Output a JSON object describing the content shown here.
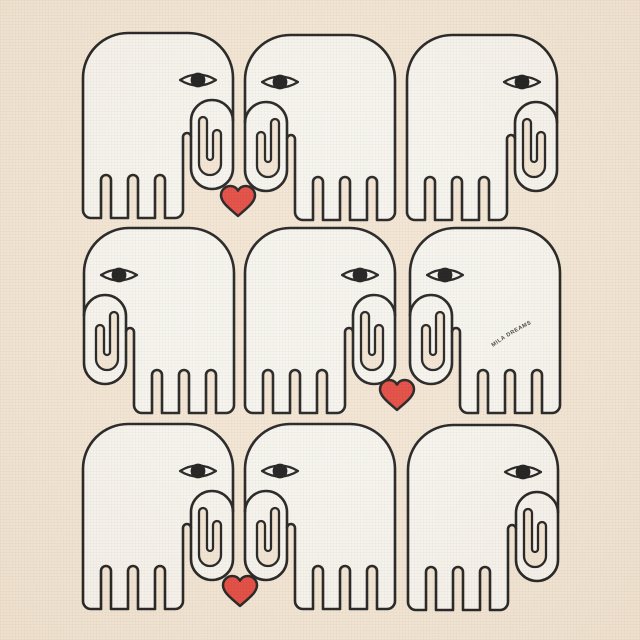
{
  "artwork": {
    "description": "Seamless-style pattern of nine outlined elephants with curled trunks facing each other, with red hearts between kissing trunk pairs, printed on cream fabric.",
    "grid": "3x3"
  },
  "brand": {
    "text": "MILA DREAMS"
  },
  "colors": {
    "background": "#f2e5d3",
    "elephant": "#f6f4ee",
    "outline": "#1c1c1c",
    "heart": "#e2463c",
    "pupil": "#171717",
    "brand_text": "#3c3c3c"
  },
  "figures": {
    "elephant_size": {
      "width": 150,
      "height": 185
    },
    "elephants": [
      {
        "id": "row1-left",
        "x": 83,
        "y": 33,
        "facing": "right"
      },
      {
        "id": "row1-mid",
        "x": 245,
        "y": 35,
        "facing": "left"
      },
      {
        "id": "row1-right",
        "x": 407,
        "y": 35,
        "facing": "right"
      },
      {
        "id": "row2-left",
        "x": 84,
        "y": 228,
        "facing": "left"
      },
      {
        "id": "row2-mid",
        "x": 245,
        "y": 228,
        "facing": "right"
      },
      {
        "id": "row2-right",
        "x": 410,
        "y": 228,
        "facing": "left"
      },
      {
        "id": "row3-left",
        "x": 83,
        "y": 424,
        "facing": "right"
      },
      {
        "id": "row3-mid",
        "x": 245,
        "y": 424,
        "facing": "left"
      },
      {
        "id": "row3-right",
        "x": 408,
        "y": 425,
        "facing": "right"
      }
    ],
    "hearts": [
      {
        "id": "heart-row1",
        "cx": 238,
        "cy": 201
      },
      {
        "id": "heart-row2",
        "cx": 397,
        "cy": 395
      },
      {
        "id": "heart-row3",
        "cx": 240,
        "cy": 591
      }
    ]
  }
}
